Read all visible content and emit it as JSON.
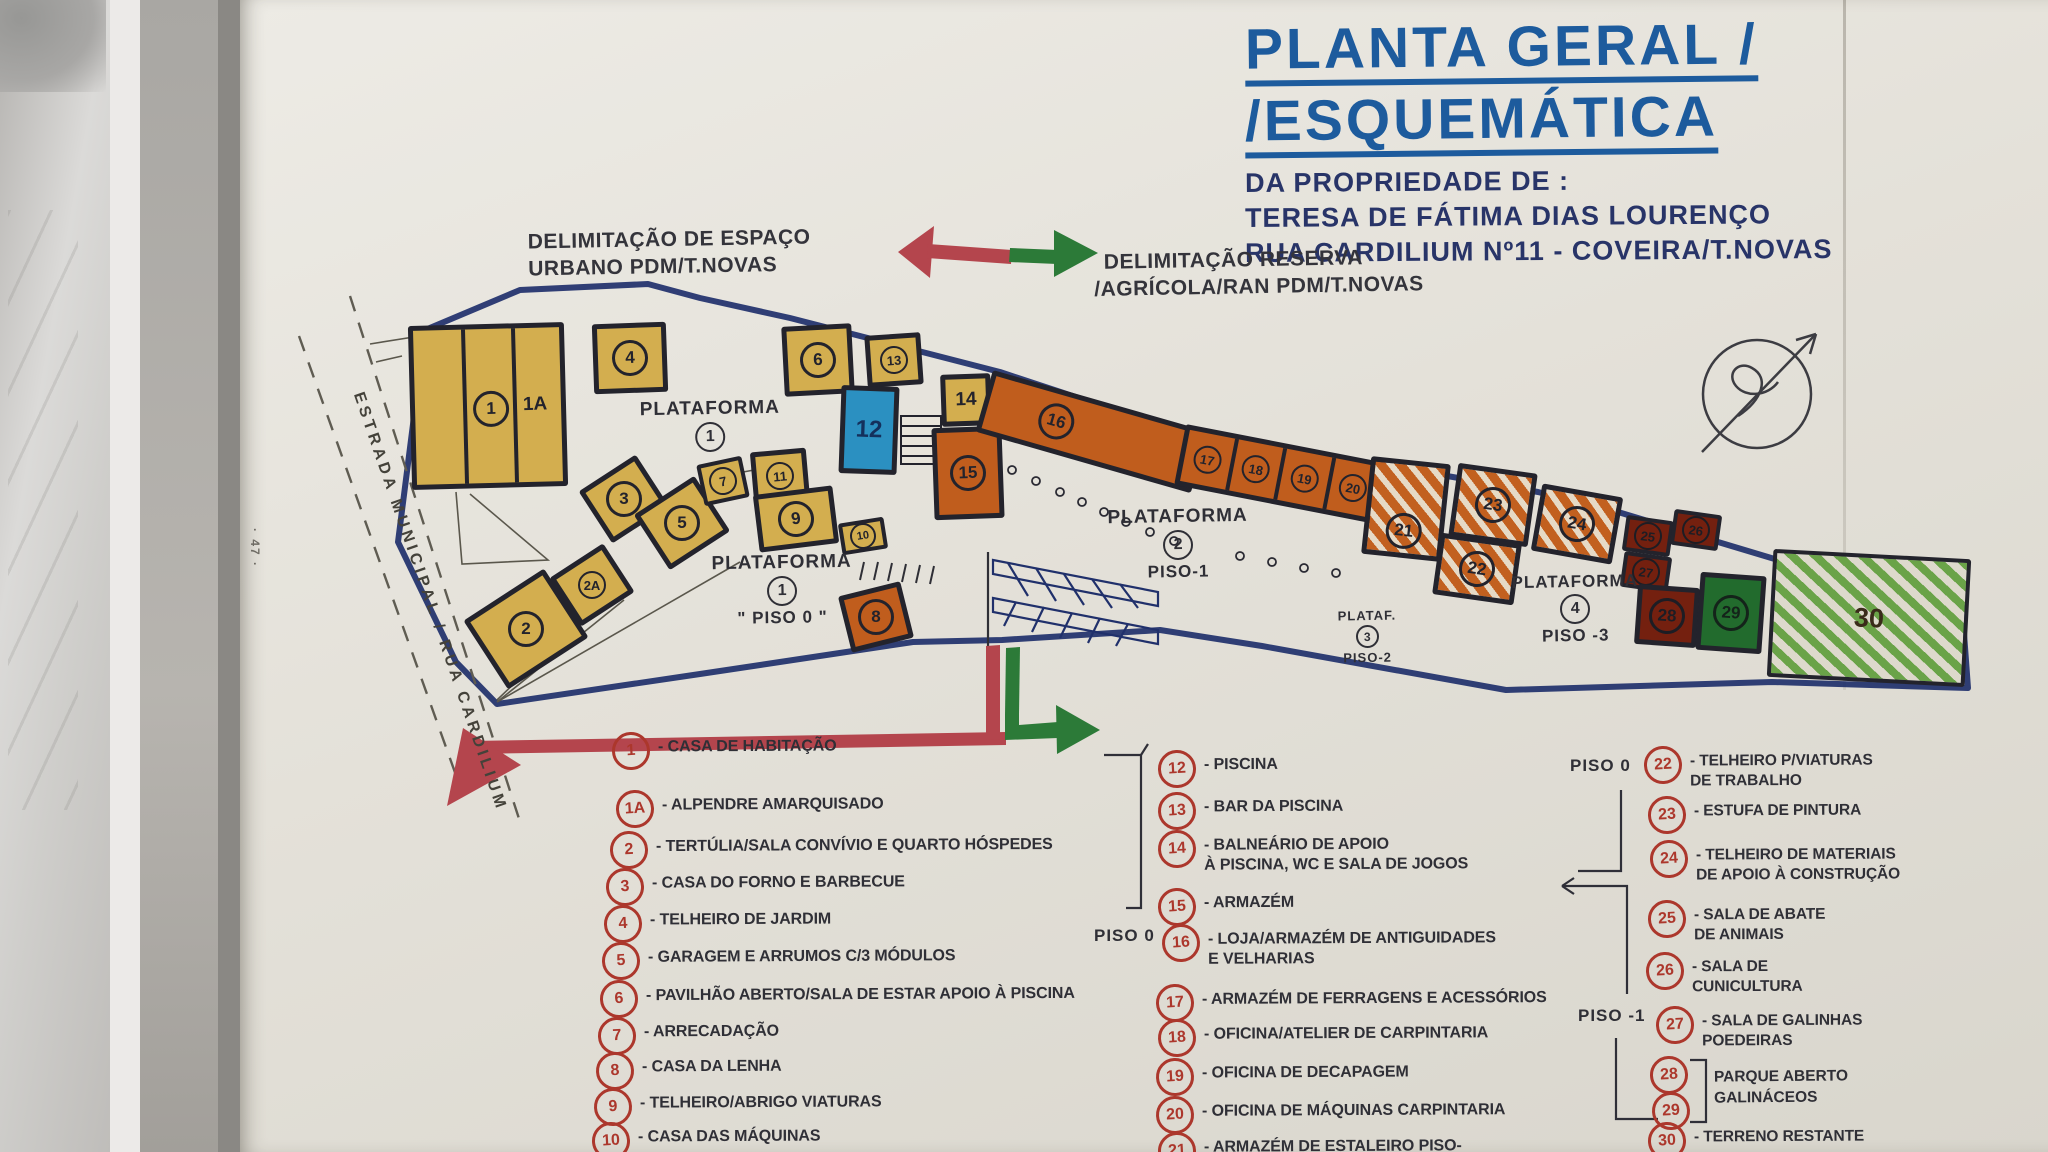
{
  "photo": {
    "page_number": "· 47 ·"
  },
  "title": {
    "line1": "PLANTA GERAL /",
    "line2": "/ESQUEMÁTICA",
    "sub1": "DA PROPRIEDADE DE :",
    "sub2": "TERESA DE FÁTIMA DIAS LOURENÇO",
    "sub3": "RUA CARDILIUM Nº11 - COVEIRA/T.NOVAS"
  },
  "annotations": {
    "delim_urbano_l1": "DELIMITAÇÃO DE ESPAÇO",
    "delim_urbano_l2": "URBANO  PDM/T.NOVAS",
    "delim_reserva_l1": "DELIMITAÇÃO RESERVA",
    "delim_reserva_l2": "/AGRÍCOLA/RAN  PDM/T.NOVAS",
    "road": "ESTRADA  MUNICIPAL / RUA  CARDILIUM"
  },
  "plan": {
    "plataforma1": {
      "name": "PLATAFORMA",
      "num": "1"
    },
    "plataforma1b": {
      "name": "PLATAFORMA",
      "num": "1",
      "piso": "\" PISO 0 \""
    },
    "plataforma2": {
      "name": "PLATAFORMA",
      "num": "2",
      "piso": "PISO-1"
    },
    "plataforma3": {
      "name": "PLATAF.",
      "num": "3",
      "piso": "PISO-2"
    },
    "plataforma4": {
      "name": "PLATAFORMA",
      "num": "4",
      "piso": "PISO -3"
    },
    "buildings": {
      "b1": "1",
      "b1a": "1A",
      "b2": "2",
      "b2a": "2A",
      "b3": "3",
      "b4": "4",
      "b5": "5",
      "b6": "6",
      "b7": "7",
      "b8": "8",
      "b9": "9",
      "b10": "10",
      "b11": "11",
      "b12": "12",
      "b13": "13",
      "b14": "14",
      "b15": "15",
      "b16": "16",
      "b17": "17",
      "b18": "18",
      "b19": "19",
      "b20": "20",
      "b21": "21",
      "b22": "22",
      "b23": "23",
      "b24": "24",
      "b25": "25",
      "b26": "26",
      "b27": "27",
      "b28": "28",
      "b29": "29",
      "b30": "30"
    }
  },
  "legend": {
    "col1": [
      {
        "num": "1",
        "text": "- CASA DE HABITAÇÃO"
      },
      {
        "num": "1A",
        "text": "- ALPENDRE AMARQUISADO"
      },
      {
        "num": "2",
        "text": "- TERTÚLIA/SALA CONVÍVIO E QUARTO HÓSPEDES"
      },
      {
        "num": "3",
        "text": "- CASA DO FORNO E BARBECUE"
      },
      {
        "num": "4",
        "text": "- TELHEIRO DE JARDIM"
      },
      {
        "num": "5",
        "text": "- GARAGEM E ARRUMOS C/3 MÓDULOS"
      },
      {
        "num": "6",
        "text": "- PAVILHÃO ABERTO/SALA DE ESTAR APOIO À PISCINA"
      },
      {
        "num": "7",
        "text": "- ARRECADAÇÃO"
      },
      {
        "num": "8",
        "text": "- CASA DA LENHA"
      },
      {
        "num": "9",
        "text": "- TELHEIRO/ABRIGO VIATURAS"
      },
      {
        "num": "10",
        "text": "- CASA DAS MÁQUINAS"
      },
      {
        "num": "11",
        "text": ""
      }
    ],
    "col2_piso0": "PISO 0",
    "col2": [
      {
        "num": "12",
        "text": "- PISCINA",
        "text2": ""
      },
      {
        "num": "13",
        "text": "- BAR DA PISCINA",
        "text2": ""
      },
      {
        "num": "14",
        "text": "- BALNEÁRIO DE APOIO",
        "text2": "À PISCINA, WC E SALA DE JOGOS"
      },
      {
        "num": "15",
        "text": "- ARMAZÉM",
        "text2": ""
      },
      {
        "num": "16",
        "text": "- LOJA/ARMAZÉM DE ANTIGUIDADES",
        "text2": "E VELHARIAS"
      },
      {
        "num": "17",
        "text": "- ARMAZÉM DE FERRAGENS E ACESSÓRIOS",
        "text2": ""
      },
      {
        "num": "18",
        "text": "- OFICINA/ATELIER DE CARPINTARIA",
        "text2": ""
      },
      {
        "num": "19",
        "text": "- OFICINA DE DECAPAGEM",
        "text2": ""
      },
      {
        "num": "20",
        "text": "- OFICINA DE MÁQUINAS CARPINTARIA",
        "text2": ""
      },
      {
        "num": "21",
        "text": "- ARMAZÉM DE ESTALEIRO PISO-",
        "text2": ""
      }
    ],
    "col3_piso0": "PISO 0",
    "col3_piso1": "PISO -1",
    "col3": [
      {
        "num": "22",
        "text": "- TELHEIRO P/VIATURAS",
        "text2": "DE TRABALHO"
      },
      {
        "num": "23",
        "text": "- ESTUFA DE PINTURA",
        "text2": ""
      },
      {
        "num": "24",
        "text": "- TELHEIRO DE MATERIAIS",
        "text2": "DE APOIO À CONSTRUÇÃO"
      },
      {
        "num": "25",
        "text": "- SALA DE ABATE",
        "text2": "DE ANIMAIS"
      },
      {
        "num": "26",
        "text": "- SALA DE",
        "text2": "CUNICULTURA"
      },
      {
        "num": "27",
        "text": "- SALA DE GALINHAS",
        "text2": "POEDEIRAS"
      },
      {
        "num": "28",
        "text": "",
        "text2": ""
      },
      {
        "num": "29",
        "text": "",
        "text2": ""
      },
      {
        "num": "30",
        "text": "- TERRENO RESTANTE",
        "text2": ""
      }
    ],
    "bracket_label1": "PARQUE ABERTO",
    "bracket_label2": "GALINÁCEOS"
  }
}
